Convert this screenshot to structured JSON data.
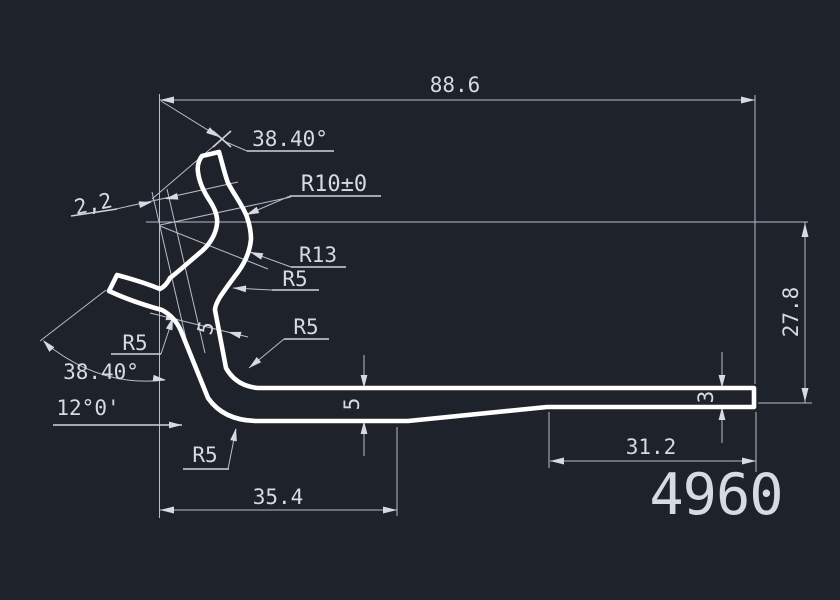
{
  "drawing": {
    "type": "cad-profile-cross-section",
    "background_color": "#1e222b",
    "profile_line_color": "#ffffff",
    "dimension_line_color": "#b7bec9",
    "text_color": "#d6dbe3",
    "part_number": "4960"
  },
  "labels": {
    "dim_total_width": "88.6",
    "dim_height_right": "27.8",
    "dim_base_left": "35.4",
    "dim_base_right": "31.2",
    "dim_thickness_left": "5",
    "dim_thickness_right": "3",
    "dim_leg_wall": "5",
    "dim_gap": "2,2",
    "angle_top": "38.40°",
    "angle_bottom": "38.40°",
    "angle_leg": "12°0'",
    "radius_r10": "R10±0",
    "radius_r13": "R13",
    "radius_r5": "R5",
    "part_number": "4960"
  }
}
